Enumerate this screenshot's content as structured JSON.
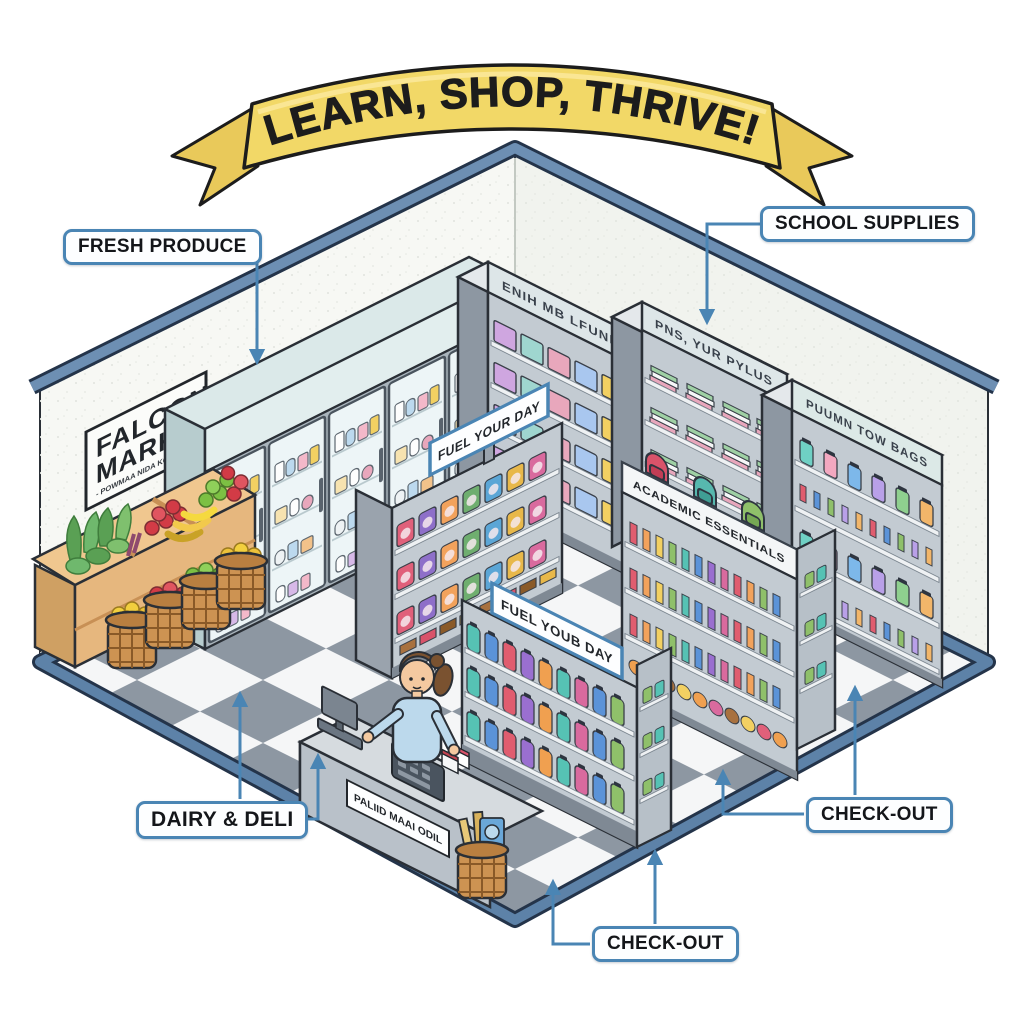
{
  "banner": {
    "text": "LEARN, SHOP, THRIVE!"
  },
  "wall_sign": {
    "title_line1": "FALCON",
    "title_line2": "MARKET",
    "subtitle": "- POWMAA NIDA KCAPOL"
  },
  "callouts": {
    "fresh_produce": "FRESH PRODUCE",
    "school_supplies": "SCHOOL SUPPLIES",
    "dairy_deli": "DAIRY & DELI",
    "checkout_right": "CHECK-OUT",
    "checkout_bottom": "CHECK-OUT"
  },
  "shelf_signs": {
    "dairy_back_shelf": "ENIH MB LFUNIS",
    "school_supplies_shelf": "PNS, YUR PYLUS",
    "bags_shelf": "PUUMN TOW BAGS",
    "snack_gondola": "FUEL YOUR DAY",
    "drink_gondola": "FUEL YOUB DAY",
    "academic_gondola": "ACADEMIC ESSENTIALS",
    "checkout_counter": "PALIID MAAI ODIL"
  },
  "colors": {
    "banner_yellow": "#f2d867",
    "callout_border_blue": "#4a85b4",
    "wall_trim_blue": "#6d8fb3",
    "floor_tile_gray": "#8d97a2",
    "floor_border_blue": "#5d82a8"
  }
}
